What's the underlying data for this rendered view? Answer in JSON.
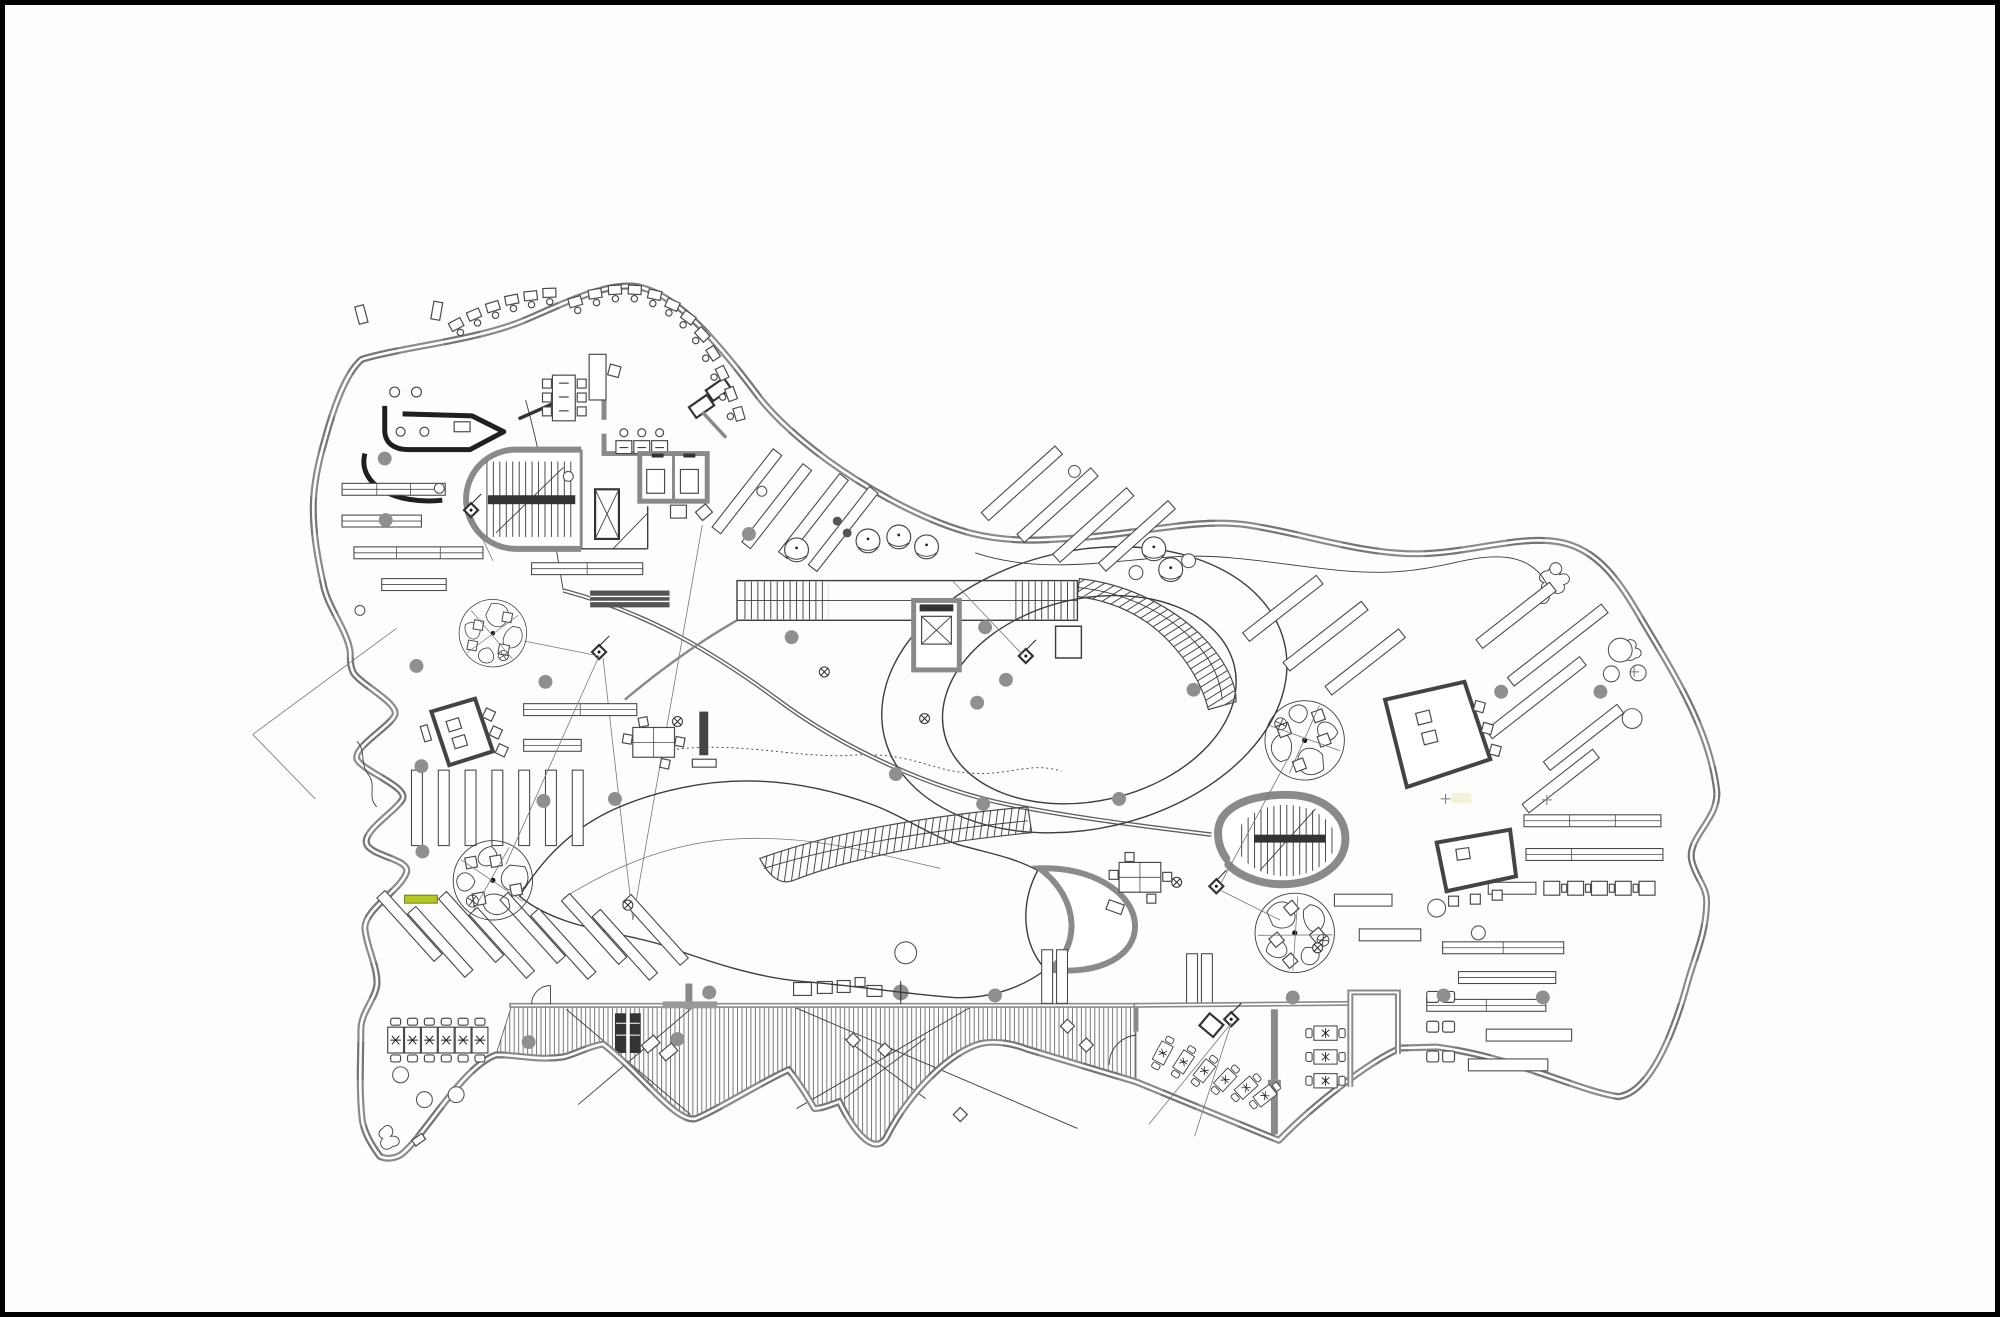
{
  "document": {
    "type": "architectural-floor-plan",
    "description_source": "line drawing only, no visible text labels",
    "visible_text": [],
    "sheet": {
      "background": "#fdfdfd",
      "border_color": "#000000"
    }
  },
  "colors": {
    "paper": "#fdfdfd",
    "ink": "#3c3c3c",
    "wall": "#8a8a8a",
    "wall_dark": "#555555",
    "black_fixture": "#1f1f1f",
    "column": "#8f8f8f",
    "hatch": "#666666",
    "accent": "#b5c822",
    "accent_border": "#6a7a10"
  },
  "features": {
    "reading_pods": 4,
    "stair_runs": 5,
    "elevator_cells": 4,
    "section_markers": 5,
    "structural_columns": 24,
    "outdoor_deck_hatched": true,
    "accent_marker": {
      "color": "#b5c822",
      "location": "west-center"
    }
  }
}
